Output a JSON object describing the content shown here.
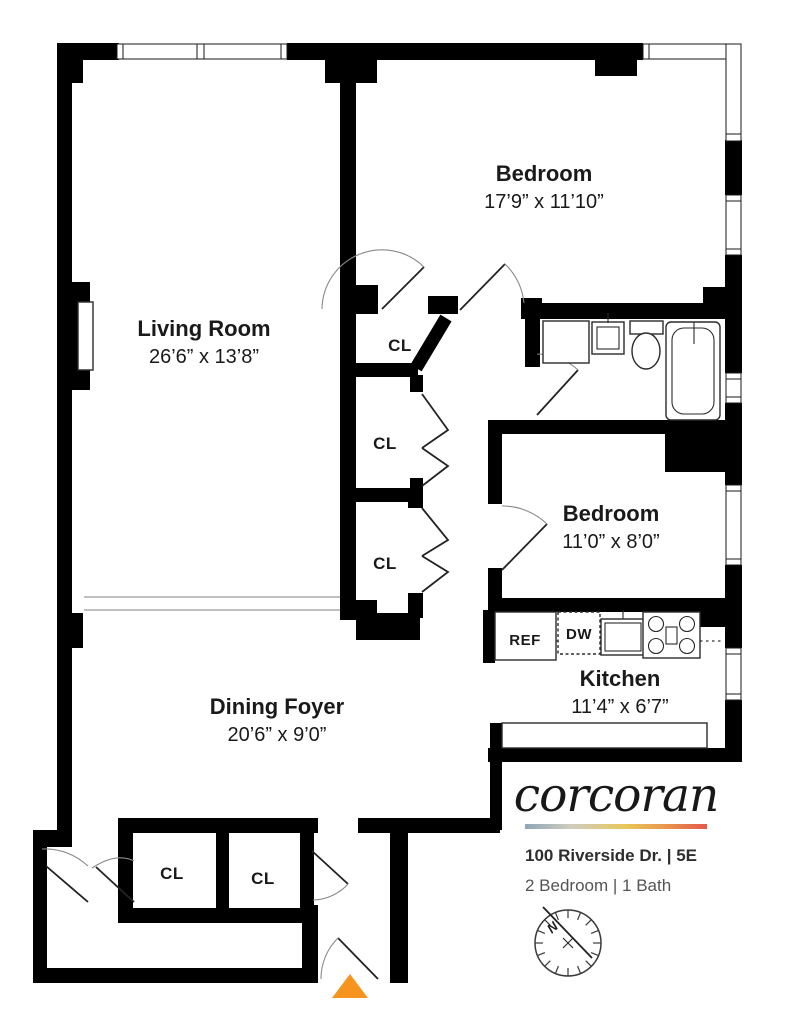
{
  "branding": {
    "logo": "corcoran",
    "address": "100 Riverside Dr. | 5E",
    "unit_info": "2 Bedroom | 1 Bath",
    "gradient": [
      "#8FA6B6",
      "#CFCCC0",
      "#E7C85A",
      "#E9944C",
      "#E25A4C"
    ]
  },
  "rooms": {
    "living_room": {
      "name": "Living Room",
      "dims": "26’6” x 13’8”"
    },
    "bedroom_1": {
      "name": "Bedroom",
      "dims": "17’9” x 11’10”"
    },
    "bedroom_2": {
      "name": "Bedroom",
      "dims": "11’0” x 8’0”"
    },
    "kitchen": {
      "name": "Kitchen",
      "dims": "11’4” x 6’7”"
    },
    "dining_foyer": {
      "name": "Dining Foyer",
      "dims": "20’6” x 9’0”"
    }
  },
  "closets": {
    "hall_1": "CL",
    "hall_2": "CL",
    "hall_3": "CL",
    "foyer_1": "CL",
    "foyer_2": "CL"
  },
  "appliances": {
    "refrigerator": "REF",
    "dishwasher": "DW"
  },
  "compass": {
    "north": "N"
  },
  "colors": {
    "wall": "#000000",
    "entry_marker": "#F7941E"
  }
}
